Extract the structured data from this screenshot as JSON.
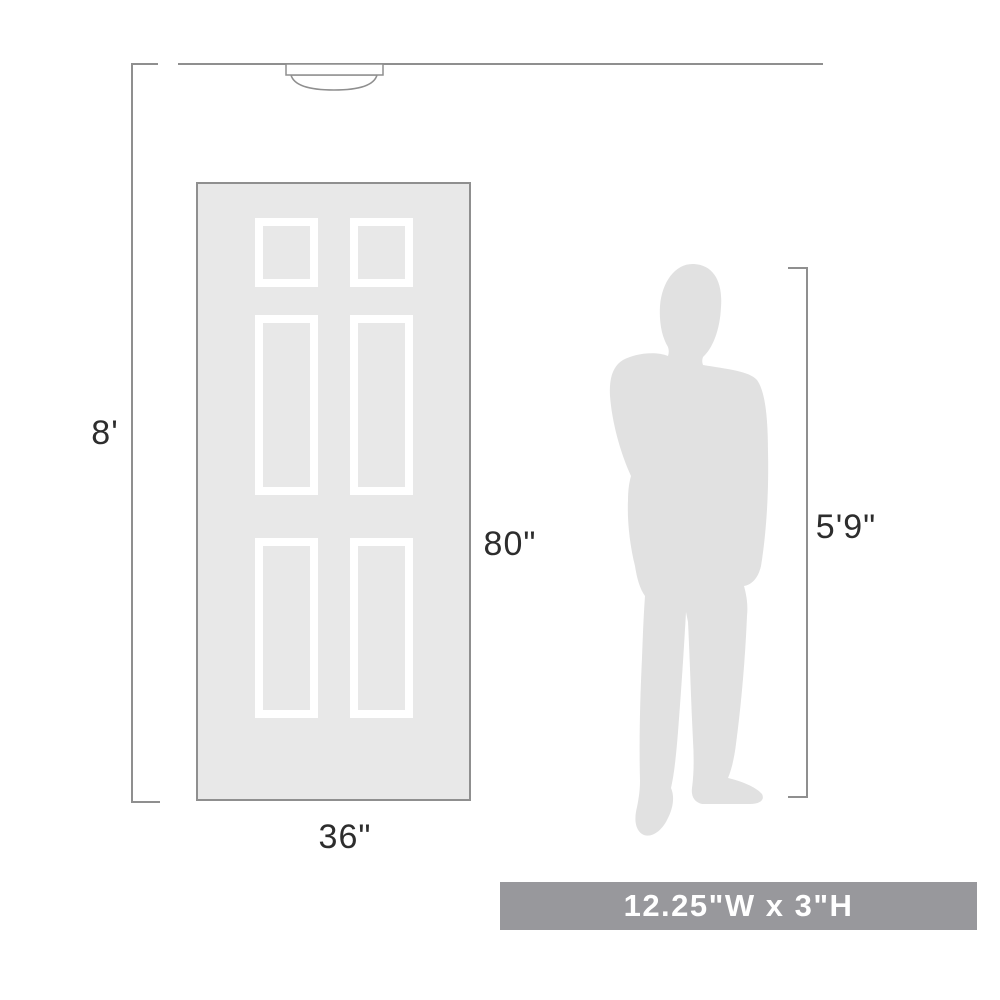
{
  "labels": {
    "ceiling_height": "8'",
    "door_height": "80\"",
    "door_width": "36\"",
    "person_height": "5'9\"",
    "product_size": "12.25\"W x 3\"H"
  },
  "colors": {
    "background": "#ffffff",
    "line": "#8f8f8f",
    "door_fill": "#e8e8e8",
    "door_border": "#8f8f8f",
    "panel_stroke": "#ffffff",
    "person_fill": "#e1e1e1",
    "fixture_fill": "#ffffff",
    "fixture_stroke": "#8f8f8f",
    "banner_bg": "#98989c",
    "banner_text": "#ffffff",
    "label_text": "#2d2d2d"
  }
}
